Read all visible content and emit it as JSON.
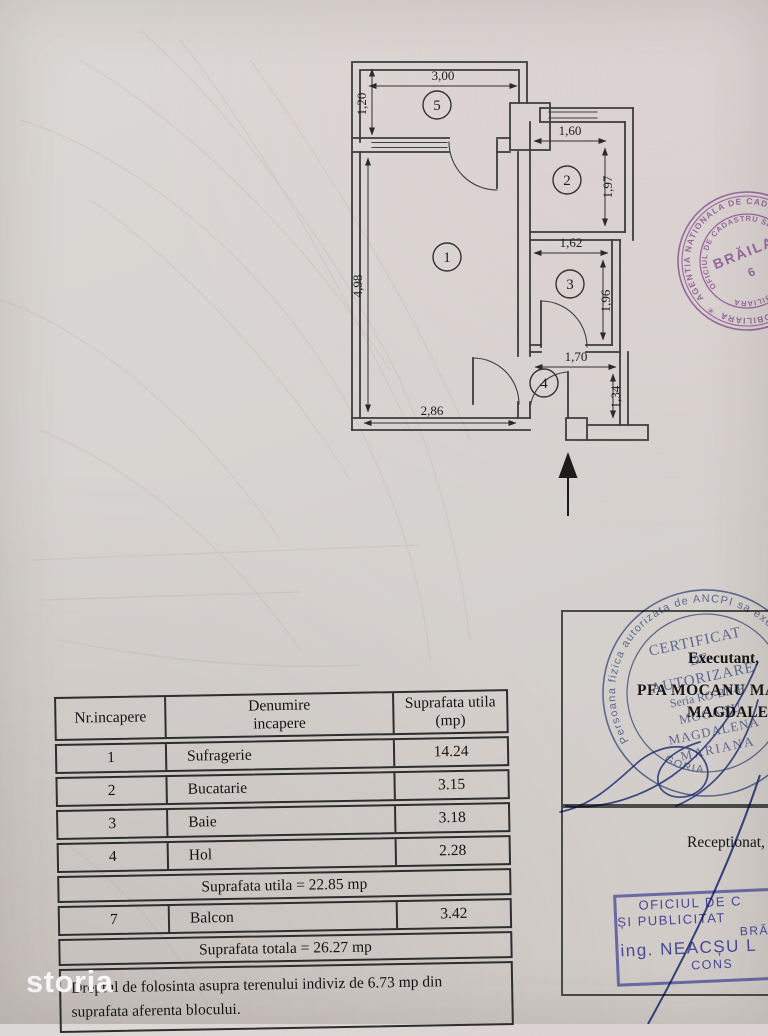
{
  "plan": {
    "room_numbers": {
      "living": "1",
      "kitchen": "2",
      "bath": "3",
      "hall": "4",
      "balcony": "5"
    },
    "dims": {
      "balcony_w": "3,00",
      "balcony_d": "1,20",
      "kitchen_w": "1,60",
      "kitchen_d": "1,97",
      "bath_w": "1,62",
      "bath_d": "1,96",
      "hall_w": "1,70",
      "hall_d": "1,34",
      "living_h": "4,98",
      "living_w": "2,86"
    }
  },
  "annotations": {
    "executant": "Executant,",
    "executant_line1": "PFA MOCANU MA",
    "executant_line2": "MAGDALENA",
    "receptionat": "Receptionat,"
  },
  "stamps": {
    "cadastre_round": {
      "color": "#a468b6",
      "ring_outer": "AGENTIA NATIONALA DE CADASTRU SI PUBLICITATE IMOBILIARA",
      "ring_inner": "OFICIUL DE CADASTRU SI PUBLICITATE IMOBILIARA",
      "center_line1": "BRĂILA",
      "center_line2": "6",
      "star": "✳"
    },
    "certificate_round": {
      "color": "#5f6fa6",
      "ring": "Persoana fizica autorizata de ANCPI sa execute lucrari",
      "line1": "CERTIFICAT",
      "line2": "DE",
      "line3": "AUTORIZARE",
      "line4": "Seria RO-BR-F",
      "line5": "MOCANU",
      "line6": "MAGDALENA",
      "line7": "MARIANA",
      "line8": "CATEGORIA"
    },
    "office_rect": {
      "color": "#5a5ac0",
      "line1": "OFICIUL DE C",
      "line2": "ȘI PUBLICITAT",
      "line3": "BRĂ",
      "line4": "ing. NEACȘU L",
      "line5": "CONS"
    }
  },
  "table": {
    "header": {
      "col1": "Nr.incapere",
      "col2a": "Denumire",
      "col2b": "incapere",
      "col3a": "Suprafata utila",
      "col3b": "(mp)"
    },
    "rows": [
      {
        "nr": "1",
        "name": "Sufragerie",
        "area": "14.24"
      },
      {
        "nr": "2",
        "name": "Bucatarie",
        "area": "3.15"
      },
      {
        "nr": "3",
        "name": "Baie",
        "area": "3.18"
      },
      {
        "nr": "4",
        "name": "Hol",
        "area": "2.28"
      }
    ],
    "subtotal": "Suprafata utila =  22.85 mp",
    "balcony_row": {
      "nr": "7",
      "name": "Balcon",
      "area": "3.42"
    },
    "total": "Suprafata  totala = 26.27 mp",
    "note_line1": "Dreptul de folosinta asupra terenului indiviz de 6.73 mp din",
    "note_line2": "suprafata  aferenta blocului."
  },
  "watermark": {
    "text": "storia"
  }
}
